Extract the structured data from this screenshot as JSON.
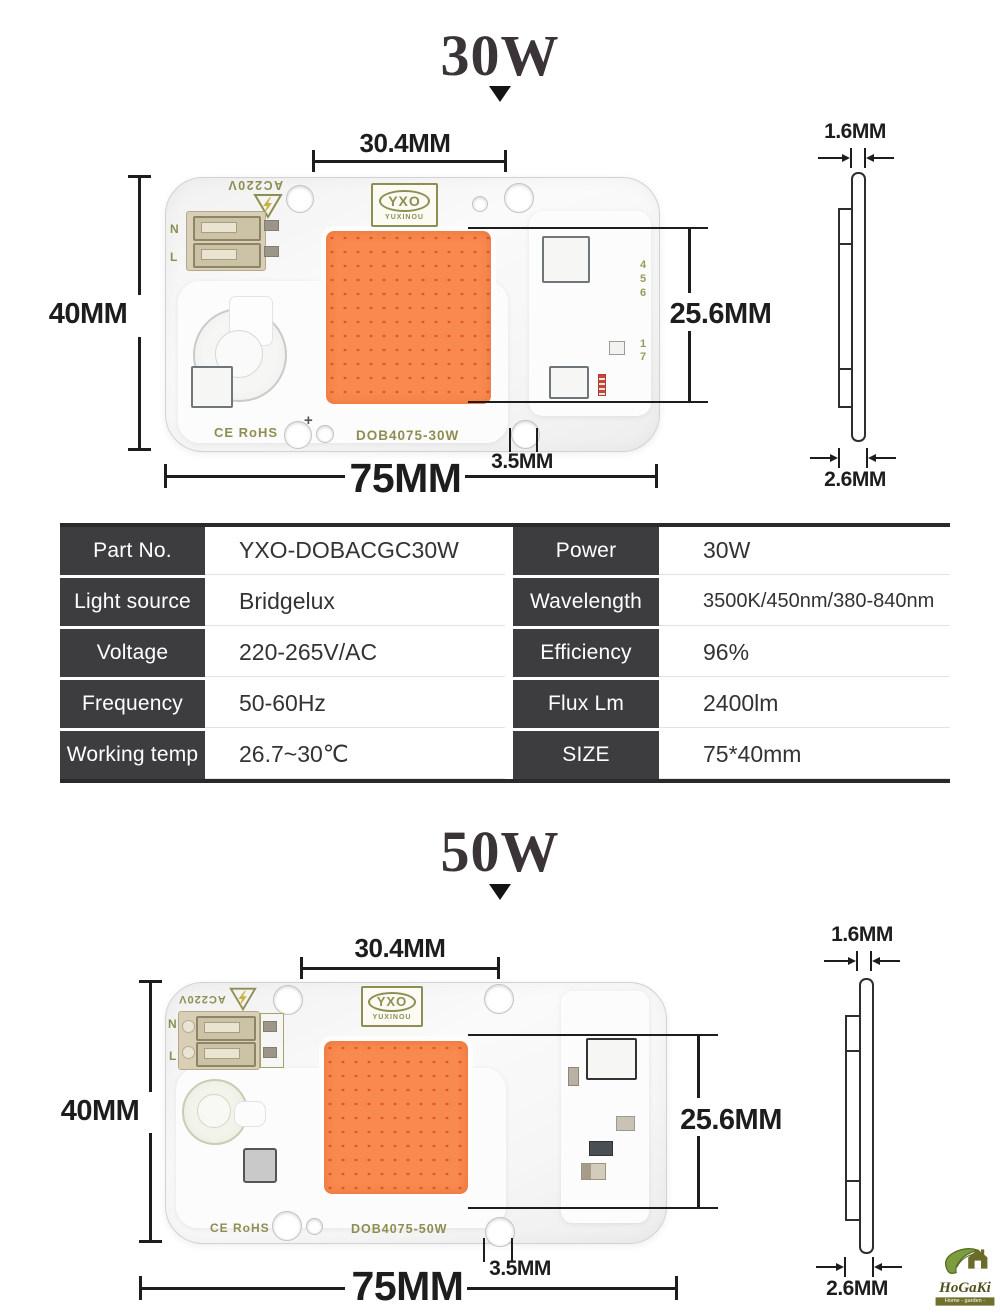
{
  "titles": {
    "w30": "30W",
    "w50": "50W"
  },
  "dims": {
    "top": "30.4MM",
    "left": "40MM",
    "right": "25.6MM",
    "bottom": "75MM",
    "hole": "3.5MM",
    "side_top": "1.6MM",
    "side_bottom": "2.6MM"
  },
  "board": {
    "ac": "AC220V",
    "n": "N",
    "l": "L",
    "logo": "YXO",
    "logo_sub": "YUXINOU",
    "ce": "CE RoHS",
    "part30": "DOB4075-30W",
    "part50": "DOB4075-50W",
    "d4": "4",
    "d5": "5",
    "d6": "6",
    "d1": "1",
    "d7": "7",
    "cn": "Cn",
    "plus": "+"
  },
  "table": {
    "rows": [
      {
        "label1": "Part No.",
        "value1": "YXO-DOBACGC30W",
        "label2": "Power",
        "value2": "30W"
      },
      {
        "label1": "Light source",
        "value1": "Bridgelux",
        "label2": "Wavelength",
        "value2": "3500K/450nm/380-840nm"
      },
      {
        "label1": "Voltage",
        "value1": "220-265V/AC",
        "label2": "Efficiency",
        "value2": "96%"
      },
      {
        "label1": "Frequency",
        "value1": "50-60Hz",
        "label2": "Flux Lm",
        "value2": "2400lm"
      },
      {
        "label1": "Working temp",
        "value1": "26.7~30℃",
        "label2": "SIZE",
        "value2": "75*40mm"
      }
    ]
  },
  "brand": {
    "name": "HoGaKi",
    "tagline": "Home - garden - kitchen"
  },
  "colors": {
    "cob_orange": "#f8894f",
    "cob_dot": "#d64c14",
    "silkscreen_olive": "#8e8e52",
    "table_label_bg": "#3d3d40",
    "dimension_ink": "#1d1d1d"
  }
}
